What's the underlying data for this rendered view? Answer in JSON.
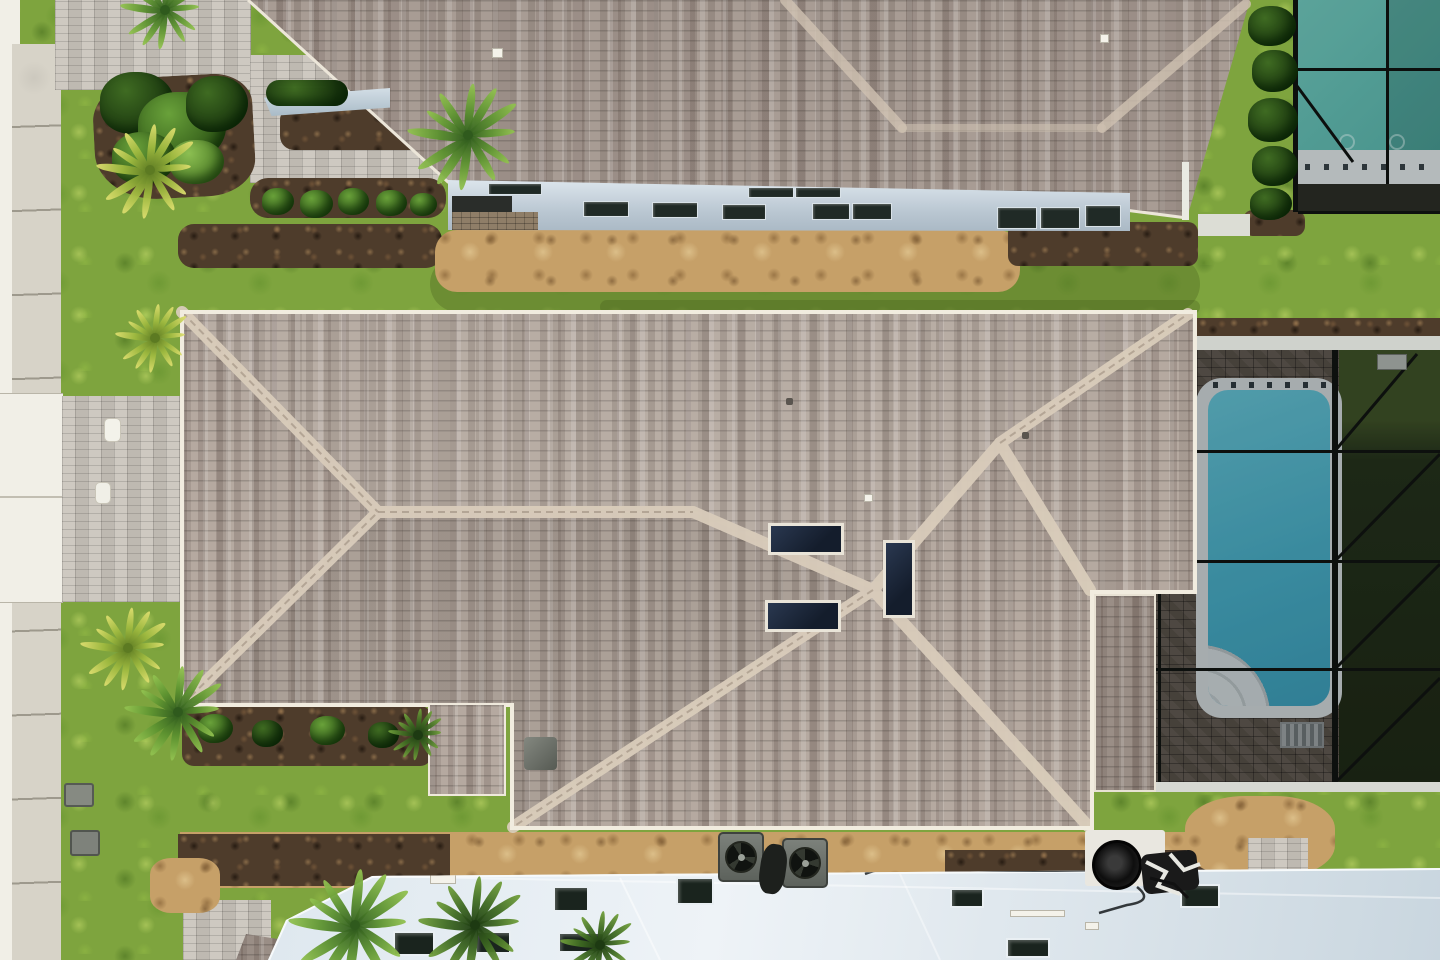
{
  "meta": {
    "type": "aerial-photograph",
    "description": "Overhead drone photo of a suburban neighborhood: a large taupe architectural-shingle hip roof in the center with two dark skylights and ridge caps; screened pool enclosures with teal swimming pools on the right; a second shingle-roof house with a blue-gray side wall and windows at top; a bright light-blue neighboring roof with dark windows at bottom; concrete sidewalk, white driveway apron and gray paver driveways on the left; green lawns, palms, shrubs and mulch beds; AC condenser units and black pool equipment along a sandy rear strip."
  },
  "objects": [
    {
      "name": "street-edge",
      "label": "white street/curb edge"
    },
    {
      "name": "sidewalk",
      "label": "concrete sidewalk with expansion joints"
    },
    {
      "name": "driveway-apron",
      "label": "bright white concrete driveway apron"
    },
    {
      "name": "paver-driveway",
      "label": "gray brick paver driveway"
    },
    {
      "name": "top-house-roof",
      "label": "neighboring shingle roof (top)"
    },
    {
      "name": "top-house-wall",
      "label": "blue-gray side wall with windows"
    },
    {
      "name": "middle-house-roof",
      "label": "central hip shingle roof with skylights"
    },
    {
      "name": "porch-roof",
      "label": "small porch roof"
    },
    {
      "name": "wing-roof",
      "label": "narrow lanai roof wing"
    },
    {
      "name": "pool-enclosure-mid",
      "label": "screened pool enclosure with teal pool and steps"
    },
    {
      "name": "pool-enclosure-top",
      "label": "screened pool enclosure (top right)"
    },
    {
      "name": "pool-enclosure-bottom",
      "label": "screened pool enclosure (bottom right)"
    },
    {
      "name": "bottom-house-roof",
      "label": "bright light roof with dark windows (bottom)"
    },
    {
      "name": "ac-units",
      "label": "two AC condenser units"
    },
    {
      "name": "pool-equipment",
      "label": "black pool pump and piping"
    },
    {
      "name": "palms-and-shrubs",
      "label": "palms, shrubs and mulch landscape beds"
    },
    {
      "name": "utility-boxes",
      "label": "gray utility boxes in lawn"
    }
  ],
  "palette": {
    "grass": "#7ea43e",
    "grass_light": "#9cc25a",
    "grass_dark": "#5c8a2e",
    "shingle": "#a89c94",
    "shingle_light": "#b5a9a0",
    "ridge_cap": "#d9ccbb",
    "fascia": "#f1ecdf",
    "pavers": "#c8c3ba",
    "deck_pavers": "#564f47",
    "sidewalk": "#d7d3c8",
    "concrete": "#f1efe7",
    "dirt": "#c6a068",
    "mulch": "#4e3c2b",
    "pool_water": "#46abc4",
    "pool_water_green": "#57aea6",
    "coping": "#cdd5d8",
    "enclosure_frame": "#0d100e",
    "hedge": "#1c2714",
    "wall_siding": "#c3d0da",
    "bottom_roof": "#dde7ee",
    "window_glass": "#1a241e"
  }
}
